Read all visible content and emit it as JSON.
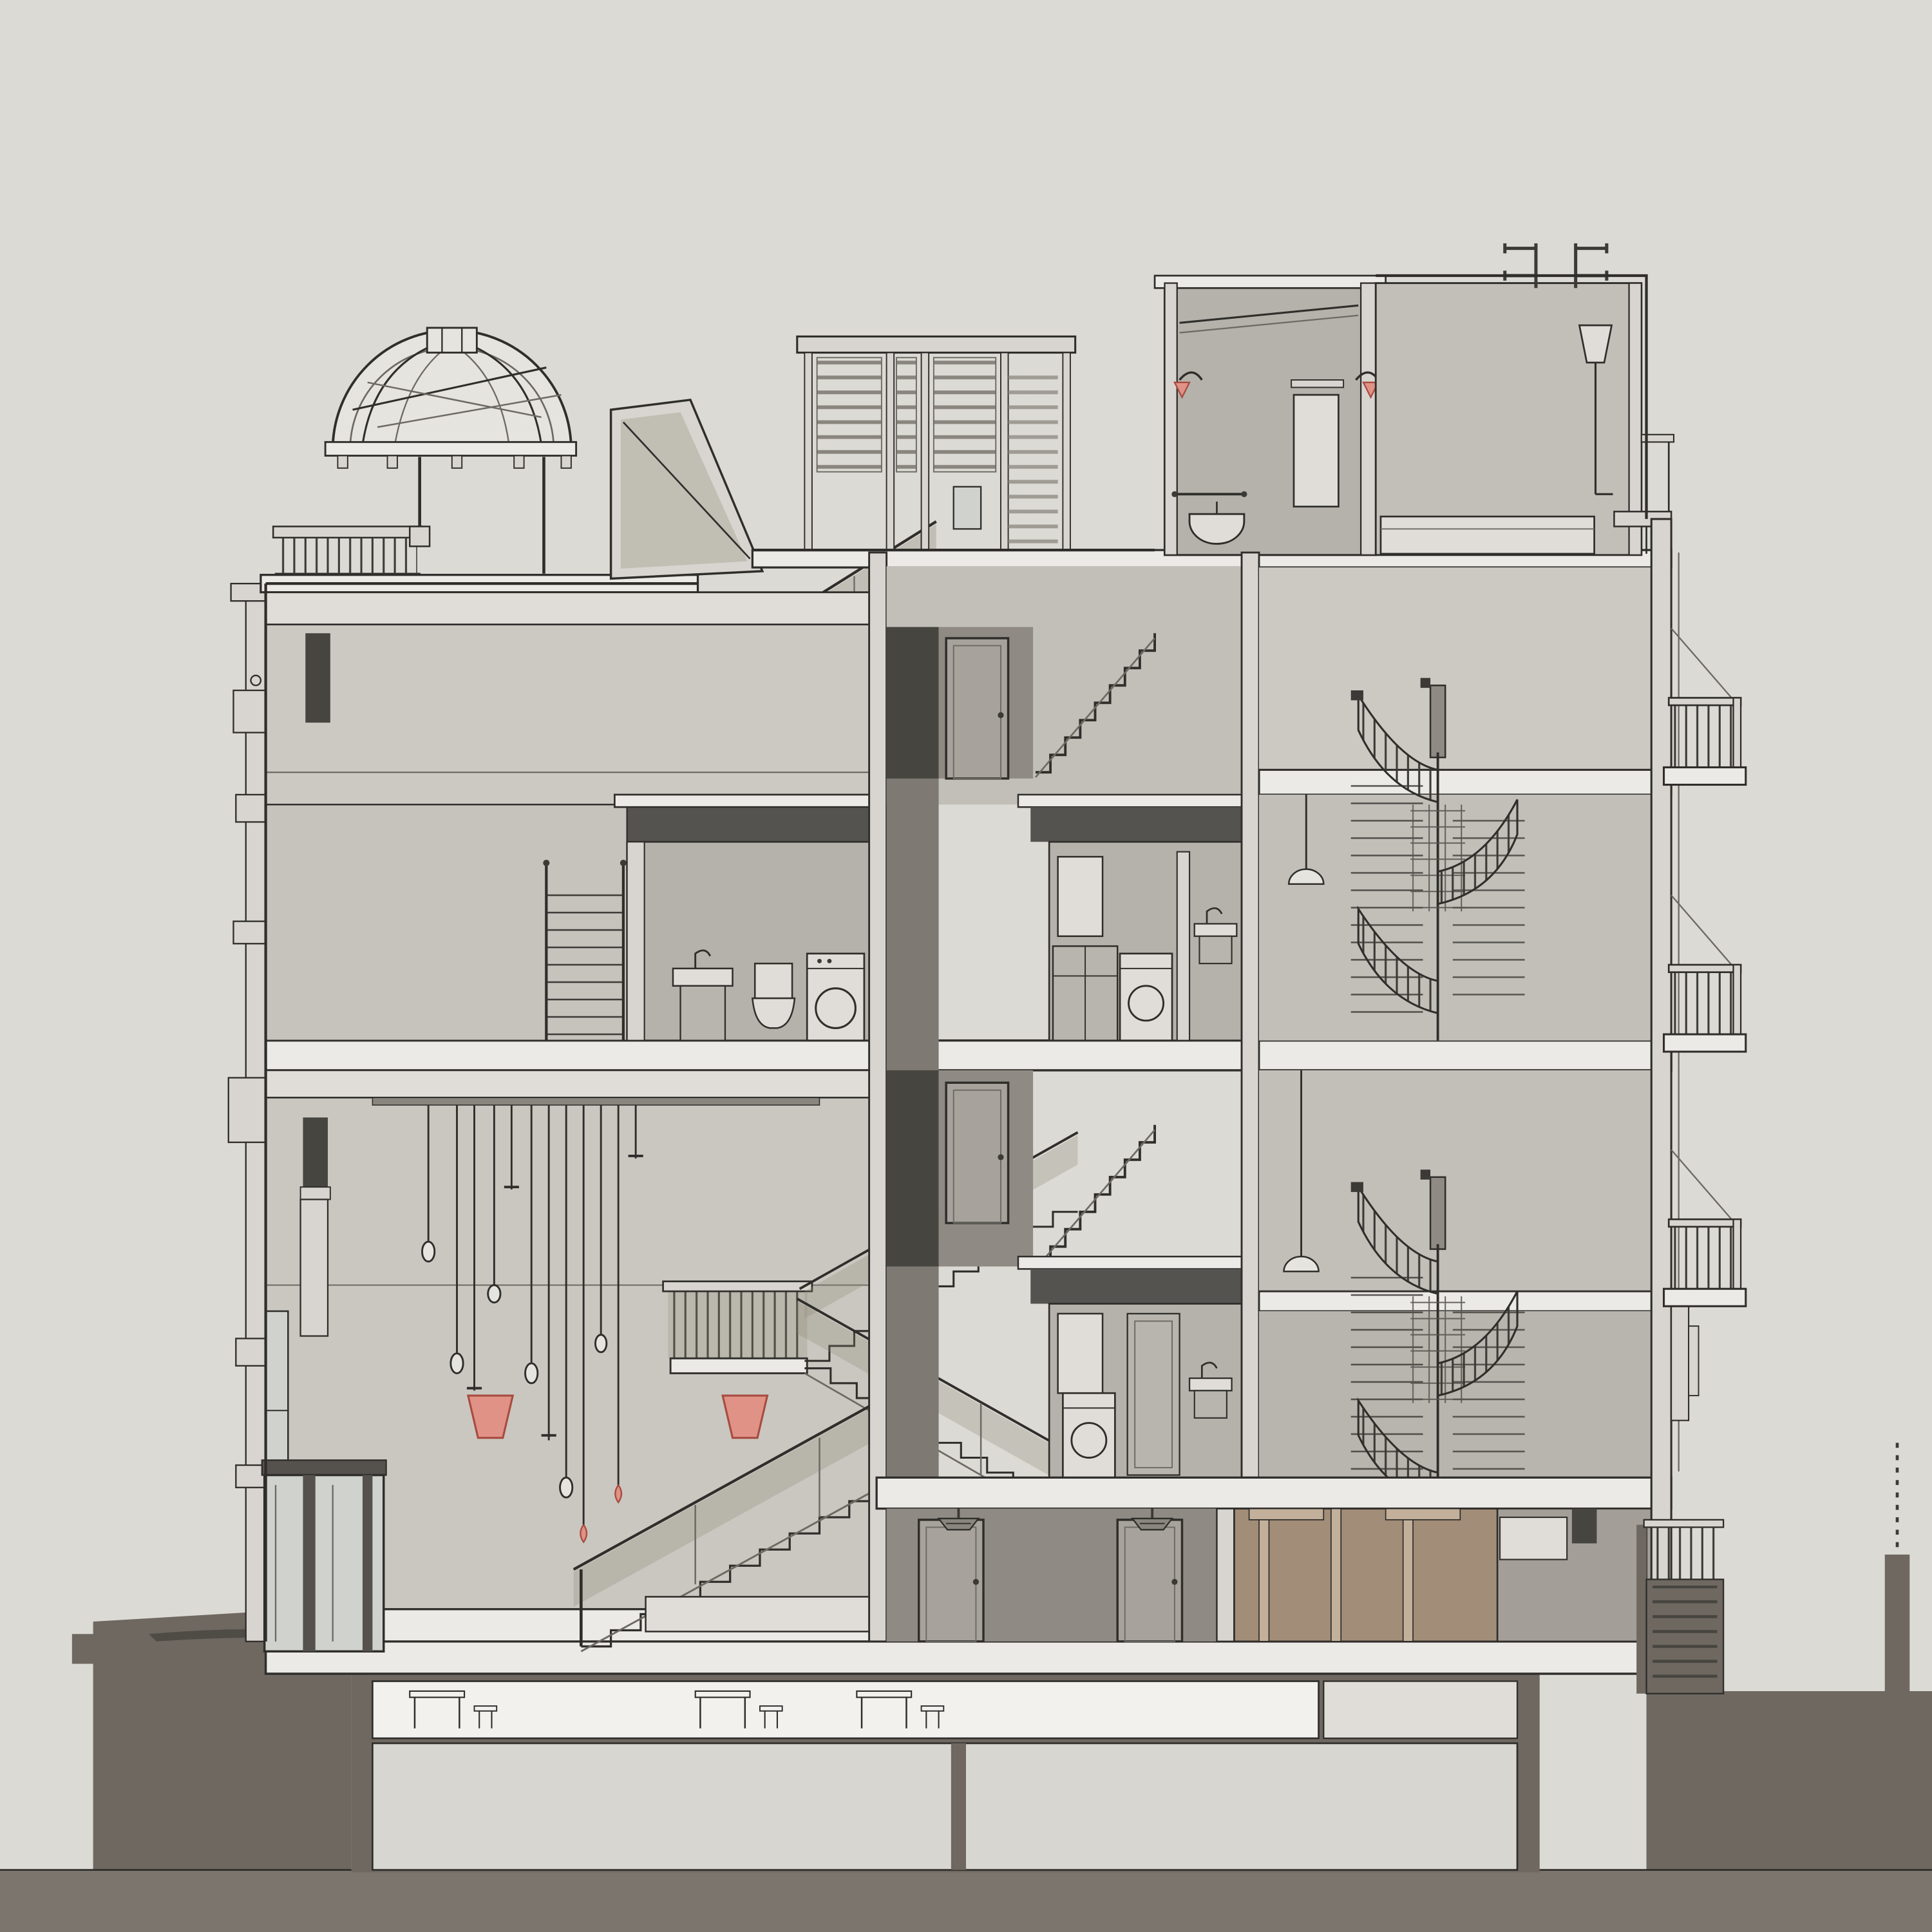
{
  "meta": {
    "kind": "architectural-section-render",
    "description": "Sectional perspective through a five-level townhouse: glass dome skylight and balustrade on the left roof, rooftop louver screen and exterior stair to a roof terrace with a rooftop bathroom, central stair core with doors, two spiral staircases in the right wing, a double-height hall with pendant light cluster and red cone sconces, scissor stair, bathroom pods with washer/toilet/sink, three cantilevered balconies on the right facade, tan timber-lined ground room, glass elevator at lower left, basement level set into dark terrain.",
    "visible_text": ""
  },
  "colors": {
    "bg": "#dcdad5",
    "line": "#2f2e2b",
    "line-soft": "#6d6a64",
    "slab-white": "#eceae6",
    "slab-white2": "#e0ddd8",
    "wall-light": "#d8d5d0",
    "room-a": "#ccc9c3",
    "room-a2": "#c6c3bd",
    "room-b": "#c2bfb9",
    "room-c": "#b8b5ae",
    "hall": "#cac7c1",
    "pod": "#b5b2ab",
    "bulkhead": "#555350",
    "shaft": "#7e7973",
    "shaft-dark": "#474540",
    "corridor": "#8f8a83",
    "corridor-light": "#a39e97",
    "door": "#a7a29b",
    "frame-dark": "#55524d",
    "glass-cool": "#cfd2cd",
    "glass-olive": "#8c8a74",
    "glass-pale": "#e6e4de",
    "tan": "#a28d79",
    "tan-light": "#c3b09a",
    "ground": "#6e6861",
    "ground-band": "#7b756e",
    "basement": "#d8d6d1",
    "metal": "#3c3a36",
    "metal-soft": "#8a867f",
    "red": "#e09287",
    "red-dark": "#a84b3f",
    "white": "#f2f1ee"
  },
  "inventory": [
    "dome-skylight",
    "roof-balustrade",
    "roof-wedge-skylight",
    "roof-stair",
    "roof-louver-screen",
    "rooftop-bathroom",
    "rooftop-room",
    "roof-antennas",
    "left-ornate-facade",
    "tall-window",
    "upper-left-room",
    "mid-left-bathroom",
    "ladder-stair",
    "double-height-hall",
    "pendant-cluster",
    "red-cone-sconce",
    "scissor-stair",
    "stair-landing",
    "bench",
    "core-corridors",
    "core-doors",
    "core-flights",
    "bathroom-pod-upper",
    "bathroom-pod-lower",
    "right-room-upper",
    "right-room-mid",
    "right-room-lower",
    "spiral-stair-upper",
    "spiral-stair-lower",
    "pendant-dome-lamp",
    "balcony",
    "right-facade",
    "exterior-stair",
    "tan-ground-room",
    "ground-corridor",
    "deco-ceiling-light",
    "elevator-shaft",
    "basement-room",
    "basement-tables",
    "terrain"
  ]
}
